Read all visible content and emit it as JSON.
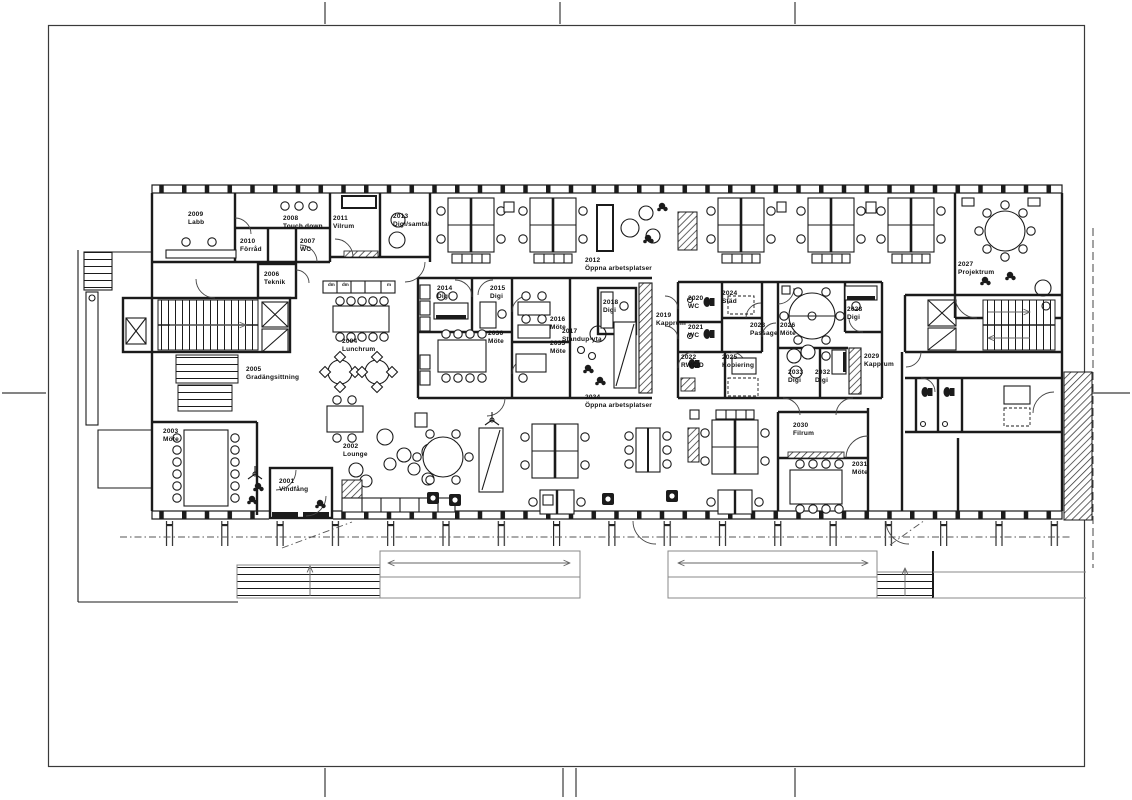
{
  "colors": {
    "line": "#1b1b1b",
    "paper": "#ffffff"
  },
  "rooms": [
    {
      "number": "2001",
      "name": "Vindfång"
    },
    {
      "number": "2002",
      "name": "Lounge"
    },
    {
      "number": "2003",
      "name": "Möte"
    },
    {
      "number": "2004",
      "name": "Lunchrum"
    },
    {
      "number": "2005",
      "name": "Gradängsittning"
    },
    {
      "number": "2006",
      "name": "Teknik"
    },
    {
      "number": "2007",
      "name": "WC"
    },
    {
      "number": "2008",
      "name": "Touch down"
    },
    {
      "number": "2009",
      "name": "Labb"
    },
    {
      "number": "2010",
      "name": "Förråd"
    },
    {
      "number": "2011",
      "name": "Vilrum"
    },
    {
      "number": "2012",
      "name": "Öppna arbetsplatser"
    },
    {
      "number": "2013",
      "name": "Digi/samtal"
    },
    {
      "number": "2014",
      "name": "Digi"
    },
    {
      "number": "2015",
      "name": "Digi"
    },
    {
      "number": "2016",
      "name": "Möte"
    },
    {
      "number": "2017",
      "name": "Standup-yta"
    },
    {
      "number": "2018",
      "name": "Digi"
    },
    {
      "number": "2019",
      "name": "Kapprum"
    },
    {
      "number": "2020",
      "name": "WC"
    },
    {
      "number": "2021",
      "name": "WC"
    },
    {
      "number": "2022",
      "name": "RWC/D"
    },
    {
      "number": "2023",
      "name": "Passage"
    },
    {
      "number": "2024",
      "name": "Städ"
    },
    {
      "number": "2025",
      "name": "Kopiering"
    },
    {
      "number": "2026",
      "name": "Möte"
    },
    {
      "number": "2027",
      "name": "Projektrum"
    },
    {
      "number": "2028",
      "name": "Digi"
    },
    {
      "number": "2029",
      "name": "Kapprum"
    },
    {
      "number": "2030",
      "name": "Filrum"
    },
    {
      "number": "2031",
      "name": "Möte"
    },
    {
      "number": "2032",
      "name": "Digi"
    },
    {
      "number": "2033",
      "name": "Digi"
    },
    {
      "number": "2034",
      "name": "Öppna arbetsplatser"
    },
    {
      "number": "2035",
      "name": "Möte"
    },
    {
      "number": "2036",
      "name": "Möte"
    }
  ],
  "kitchen": {
    "labels": [
      "dm",
      "dm",
      "m"
    ]
  }
}
